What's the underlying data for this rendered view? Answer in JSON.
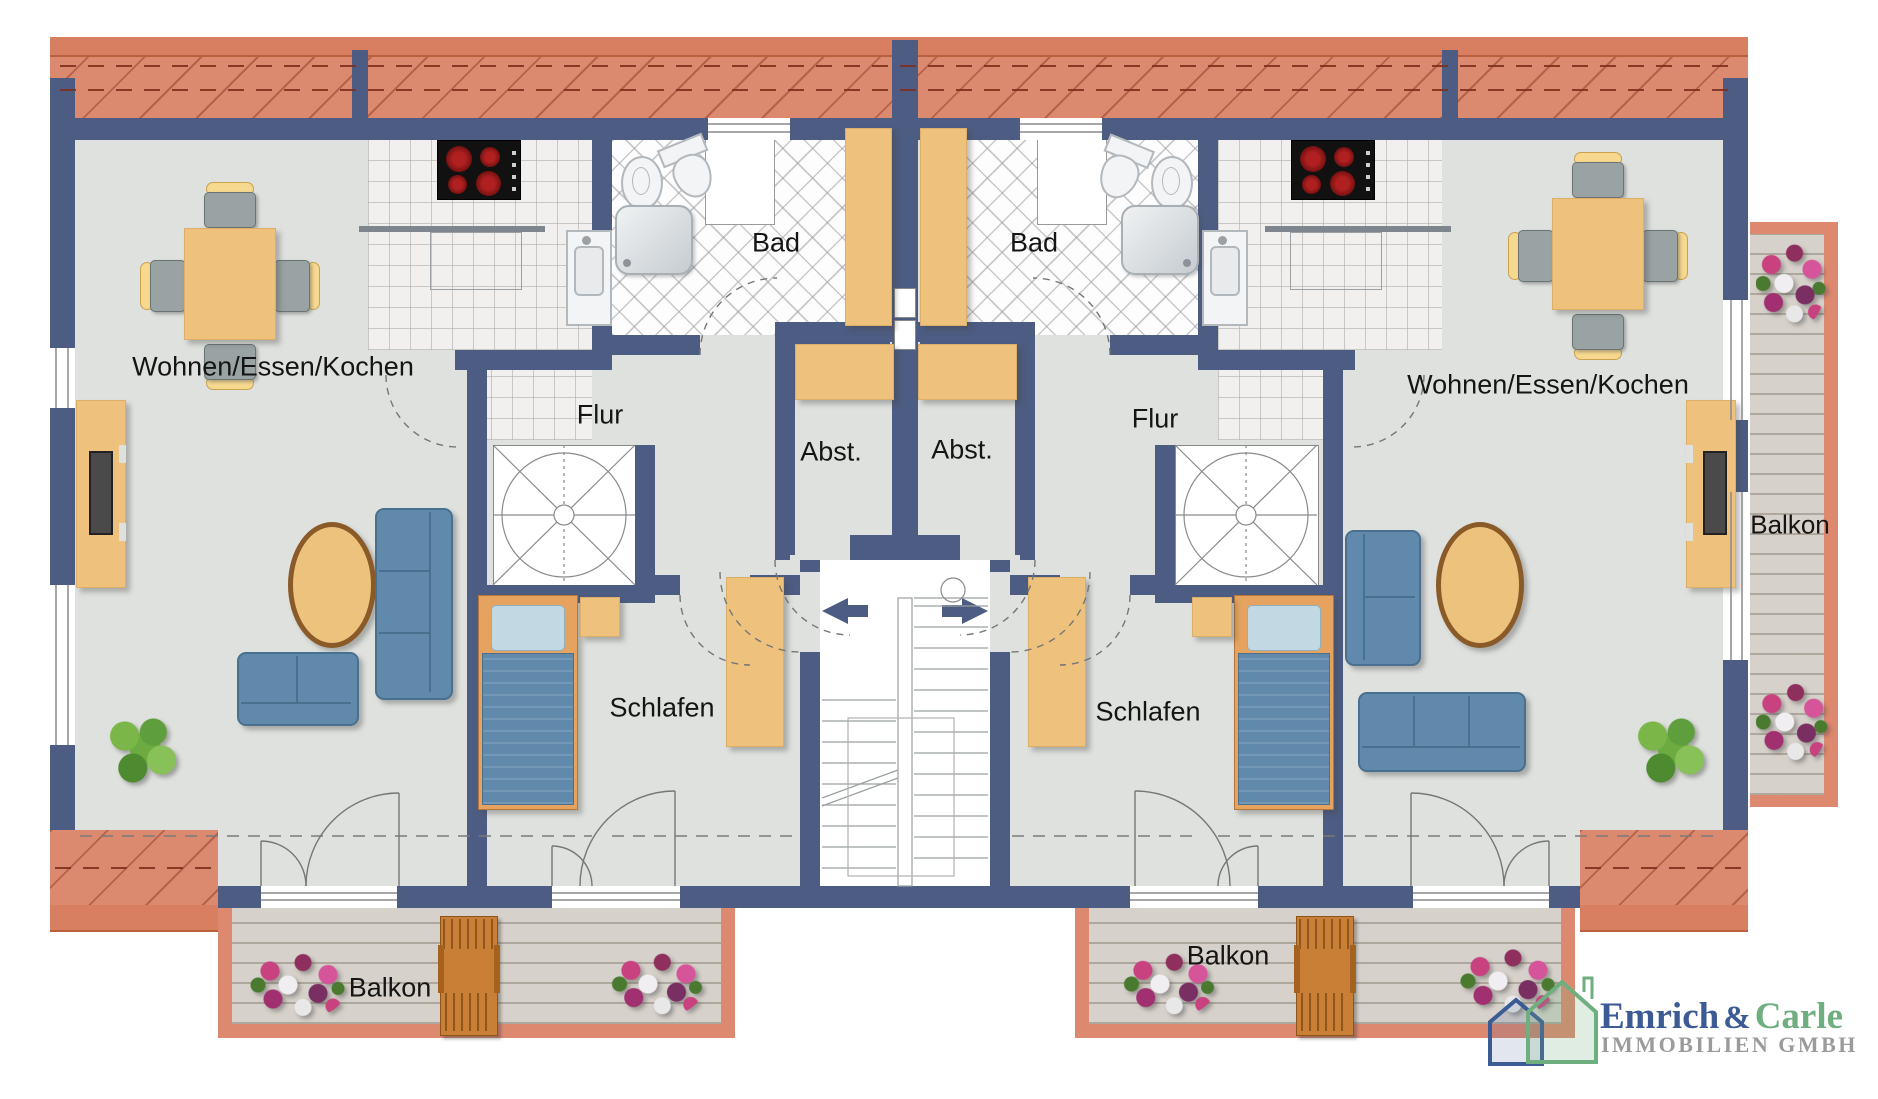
{
  "plan": {
    "rooms": {
      "living_left": "Wohnen/Essen/Kochen",
      "living_right": "Wohnen/Essen/Kochen",
      "hall_left": "Flur",
      "hall_right": "Flur",
      "bath_left": "Bad",
      "bath_right": "Bad",
      "storage_left": "Abst.",
      "storage_right": "Abst.",
      "bedroom_left": "Schlafen",
      "bedroom_right": "Schlafen",
      "balcony_bottom_left": "Balkon",
      "balcony_bottom_right": "Balkon",
      "balcony_side_right": "Balkon"
    },
    "icons": {
      "entrance_left": "arrow-left-icon",
      "entrance_right": "arrow-right-icon"
    },
    "colors": {
      "wall": "#4d5c82",
      "roof": "#dc8a6f",
      "roof_edge": "#d97f61",
      "floor": "#dfe1de",
      "wood": "#eec27d",
      "upholstery": "#6089ab",
      "deck": "#d6d1ca",
      "balcony_border": "#dd8970"
    }
  },
  "logo": {
    "name_primary": "Emrich",
    "ampersand": "&",
    "name_secondary": "Carle",
    "subtitle": "IMMOBILIEN GMBH",
    "color_primary": "#3c5a94",
    "color_secondary": "#6fae7e",
    "color_subtitle": "#9b9b9b"
  }
}
